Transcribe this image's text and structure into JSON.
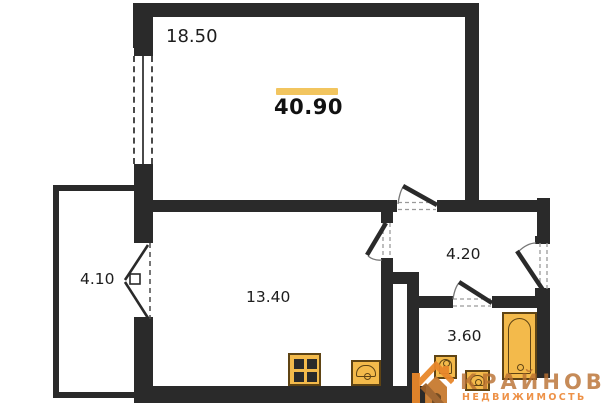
{
  "floorplan": {
    "total_area": "40.90",
    "rooms": {
      "living": {
        "area": "18.50"
      },
      "balcony": {
        "area": "4.10"
      },
      "kitchen": {
        "area": "13.40"
      },
      "hallway": {
        "area": "4.20"
      },
      "bathroom": {
        "area": "3.60"
      }
    },
    "fixtures": [
      "stove",
      "kitchen-sink",
      "toilet",
      "bathroom-sink",
      "bathtub"
    ],
    "colors": {
      "wall": "#2a2a2a",
      "fixture_fill": "#f3ba4b",
      "fixture_outline": "#5f4414",
      "accent_bar": "#f2c55f"
    }
  },
  "watermark": {
    "brand": "КРАЙНОВ",
    "tagline": "НЕДВИЖИМОСТЬ",
    "logo_orange": "#e8872b",
    "logo_brown": "#9c5f28"
  }
}
